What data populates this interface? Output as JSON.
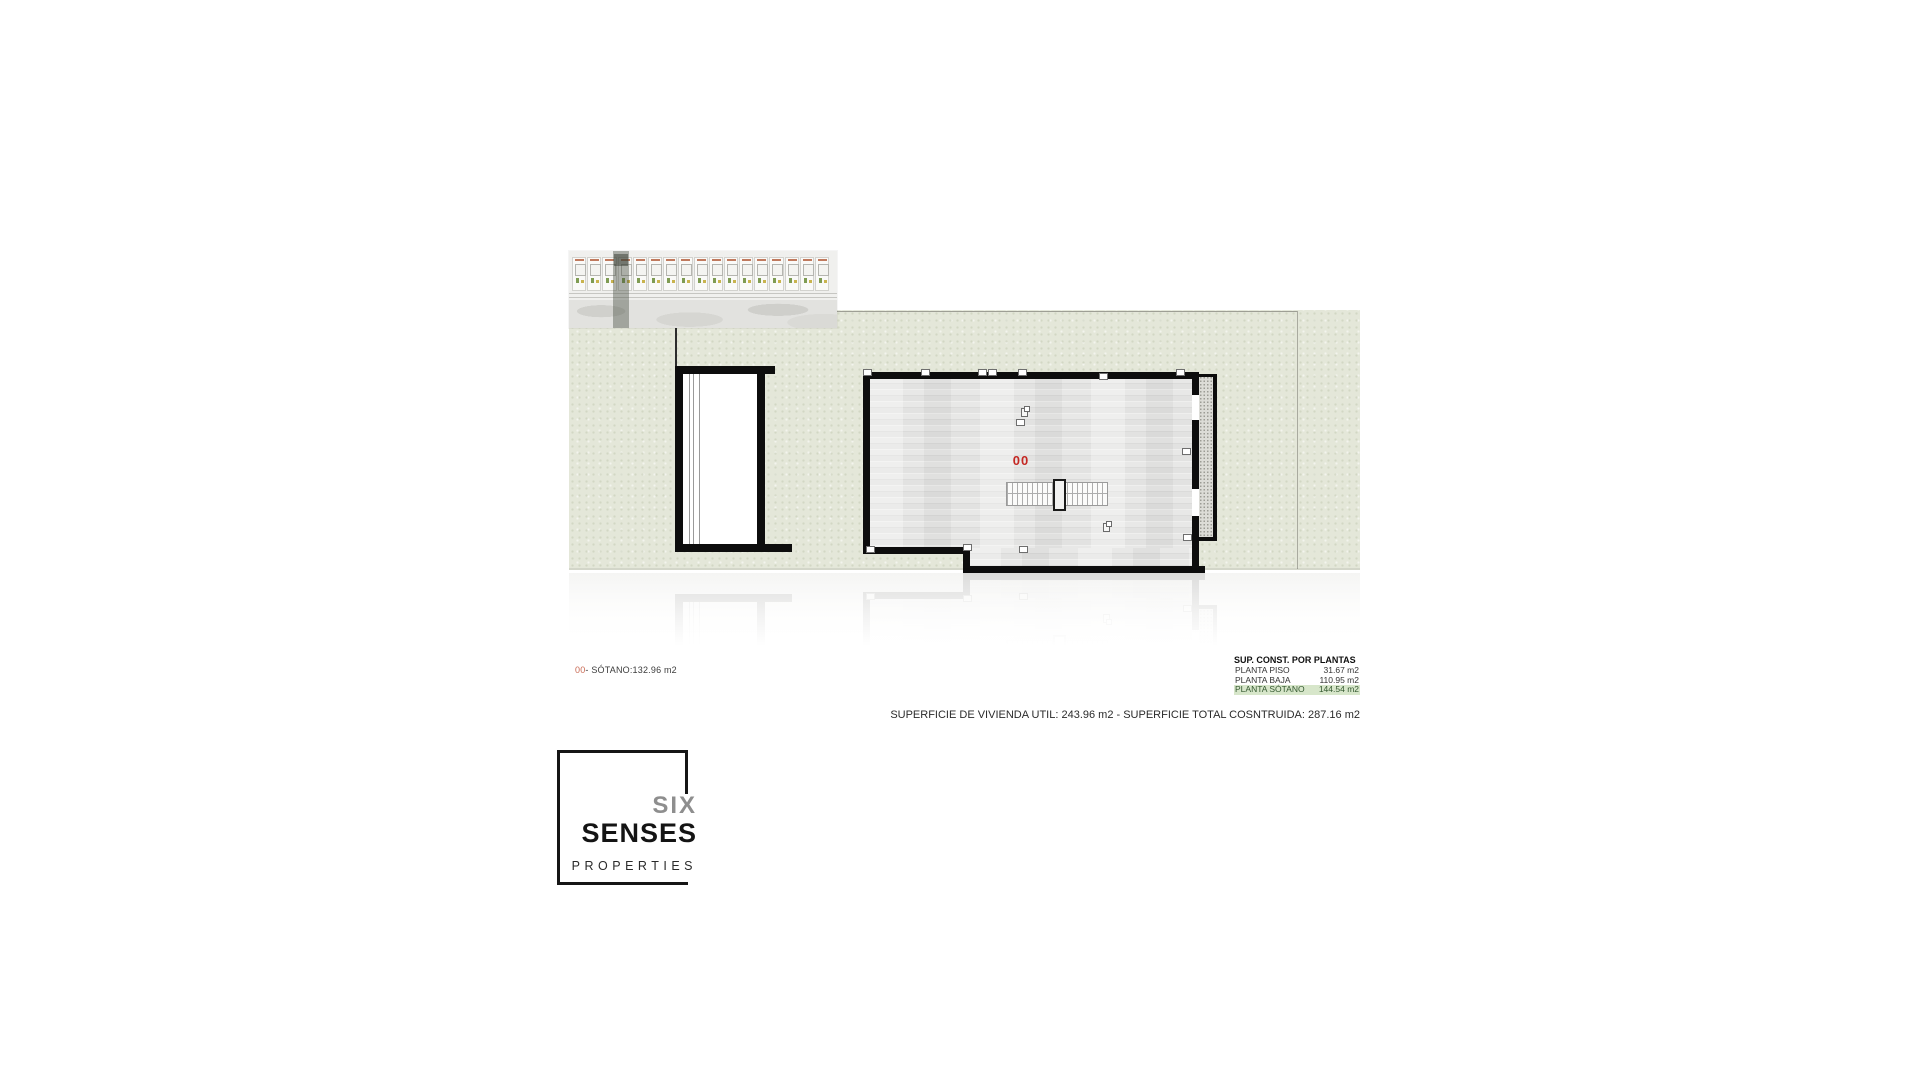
{
  "document_type": "architectural floor plan sheet",
  "colors": {
    "accent_red": "#c42823",
    "caption_red": "#c96a54",
    "terrain_green": "#e4e7d9",
    "table_highlight": "#d7e6ca",
    "table_highlight_text": "#33582f"
  },
  "site_strip": {
    "units_count": 17,
    "highlighted_unit_index": 3
  },
  "plan": {
    "floor_label": "00",
    "caption": {
      "prefix": "00",
      "text": "- SÓTANO:132.96 m2"
    }
  },
  "areas_table": {
    "header": "SUP. CONST. POR PLANTAS",
    "rows": [
      {
        "label": "PLANTA PISO",
        "value": "31.67 m2",
        "highlighted": false
      },
      {
        "label": "PLANTA BAJA",
        "value": "110.95 m2",
        "highlighted": false
      },
      {
        "label": "PLANTA SÓTANO",
        "value": "144.54 m2",
        "highlighted": true
      }
    ]
  },
  "summary": {
    "text": "SUPERFICIE DE VIVIENDA UTIL: 243.96 m2 - SUPERFICIE TOTAL COSNTRUIDA: 287.16 m2"
  },
  "logo": {
    "line1": "SIX",
    "line2": "SENSES",
    "line3": "PROPERTIES"
  }
}
